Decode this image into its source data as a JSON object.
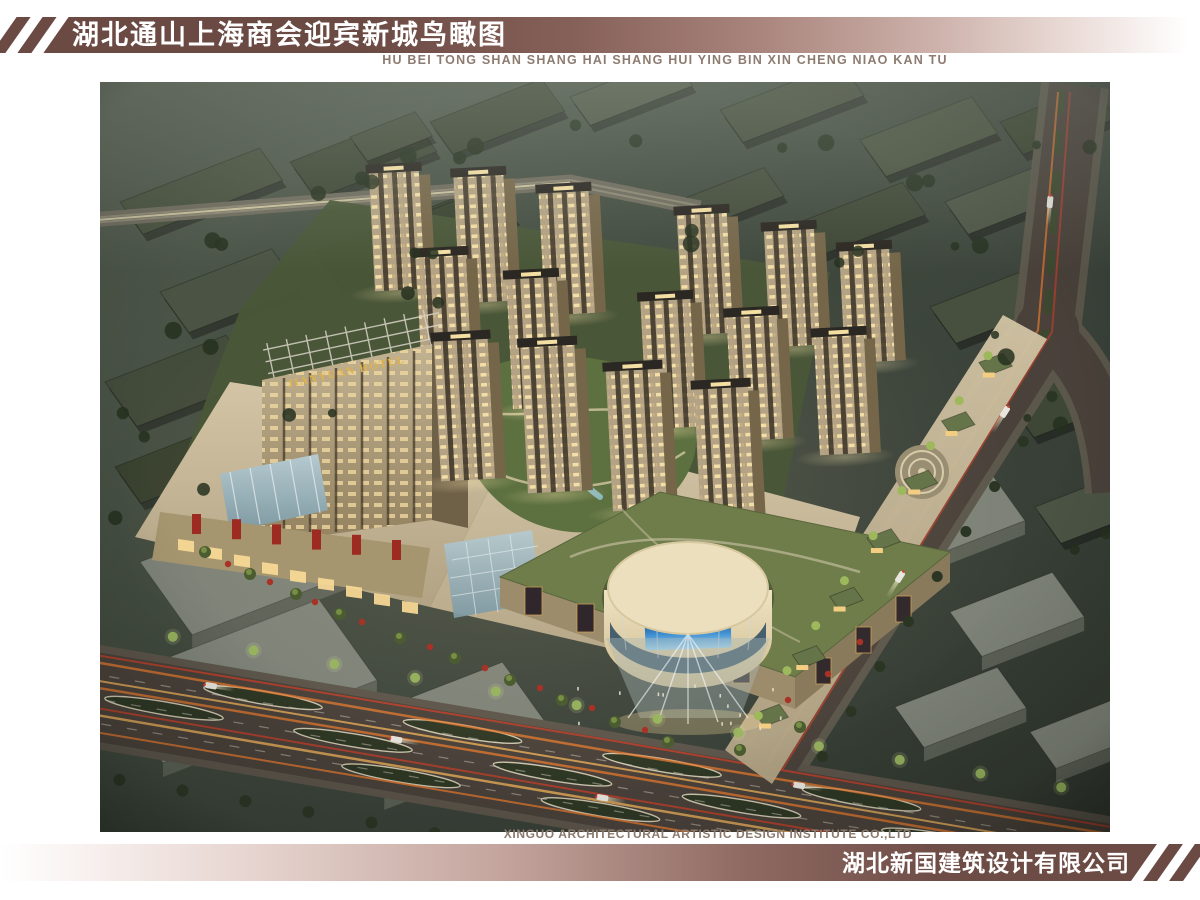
{
  "header": {
    "title_cn": "湖北通山上海商会迎宾新城鸟瞰图",
    "title_pinyin": "HU BEI TONG SHAN SHANG HAI SHANG HUI YING BIN XIN CHENG NIAO KAN TU"
  },
  "footer": {
    "credit_en": "XINGUO ARCHITECTURAL ARTISTIC DESIGN INSTITUTE CO.,LTD",
    "company_cn": "湖北新国建筑设计有限公司"
  },
  "rendering": {
    "hotel_sign": "JIANYUAN HOTEL"
  },
  "colors": {
    "band_maroon": "#6b4a44",
    "subtitle_taupe": "#8d7b70",
    "night_ground_green": "#3c443a",
    "facade_beige": "#b3a283",
    "lit_window": "#f6e1a8",
    "roof_green": "#6e7c4a",
    "plaza_beige": "#c9bb9c",
    "light_trail_orange": "#e6792f"
  }
}
